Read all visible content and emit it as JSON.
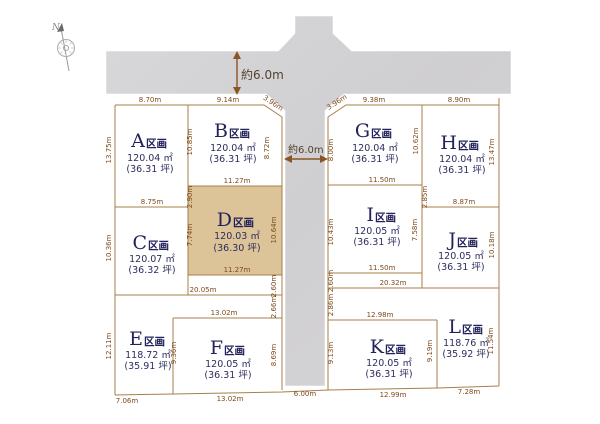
{
  "compass": {
    "north_label": "N"
  },
  "road_labels": {
    "top_width": "約6.0m",
    "center_width": "約6.0m",
    "bottom_width": "6.00m"
  },
  "plots": [
    {
      "id": "A",
      "letter": "A",
      "suffix": "区画",
      "area": "120.04 ㎡",
      "tsubo": "(36.31 坪)"
    },
    {
      "id": "B",
      "letter": "B",
      "suffix": "区画",
      "area": "120.04 ㎡",
      "tsubo": "(36.31 坪)"
    },
    {
      "id": "C",
      "letter": "C",
      "suffix": "区画",
      "area": "120.07 ㎡",
      "tsubo": "(36.32 坪)"
    },
    {
      "id": "D",
      "letter": "D",
      "suffix": "区画",
      "area": "120.03 ㎡",
      "tsubo": "(36.30 坪)"
    },
    {
      "id": "E",
      "letter": "E",
      "suffix": "区画",
      "area": "118.72 ㎡",
      "tsubo": "(35.91 坪)"
    },
    {
      "id": "F",
      "letter": "F",
      "suffix": "区画",
      "area": "120.05 ㎡",
      "tsubo": "(36.31 坪)"
    },
    {
      "id": "G",
      "letter": "G",
      "suffix": "区画",
      "area": "120.04 ㎡",
      "tsubo": "(36.31 坪)"
    },
    {
      "id": "H",
      "letter": "H",
      "suffix": "区画",
      "area": "120.04 ㎡",
      "tsubo": "(36.31 坪)"
    },
    {
      "id": "I",
      "letter": "I",
      "suffix": "区画",
      "area": "120.05 ㎡",
      "tsubo": "(36.31 坪)"
    },
    {
      "id": "J",
      "letter": "J",
      "suffix": "区画",
      "area": "120.05 ㎡",
      "tsubo": "(36.31 坪)"
    },
    {
      "id": "K",
      "letter": "K",
      "suffix": "区画",
      "area": "120.05 ㎡",
      "tsubo": "(36.31 坪)"
    },
    {
      "id": "L",
      "letter": "L",
      "suffix": "区画",
      "area": "118.76 ㎡",
      "tsubo": "(35.92 坪)"
    }
  ],
  "dims": {
    "a_top": "8.70m",
    "b_top": "9.14m",
    "g_top": "9.38m",
    "h_top": "8.90m",
    "bd_shared": "11.27m",
    "gi_shared": "11.50m",
    "ac_shared": "8.75m",
    "hj_shared": "8.87m",
    "d_bottom": "11.27m",
    "i_bottom": "11.50m",
    "ef_top": "20.05m",
    "kl_top": "20.32m",
    "f_top": "13.02m",
    "k_top": "12.98m",
    "e_bottom": "7.06m",
    "f_bottom": "13.02m",
    "road_bottom": "6.00m",
    "k_bottom": "12.99m",
    "l_bottom": "7.28m",
    "a_left": "13.75m",
    "ab_shared": "10.85m",
    "b_right": "8.72m",
    "g_left": "8.00m",
    "gh_shared": "10.62m",
    "h_right": "13.47m",
    "d_left_upper": "2.90m",
    "i_left_upper": "2.85m",
    "c_left": "10.36m",
    "d_left": "7.74m",
    "d_right": "10.64m",
    "i_left": "10.43m",
    "i_right": "7.58m",
    "j_right": "10.18m",
    "d_seg": "2.60m",
    "e_seg": "2.66m",
    "i_seg": "2.60m",
    "l_seg": "2.86m",
    "e_left": "12.11m",
    "f_left": "9.36m",
    "f_right": "8.69m",
    "k_left": "9.13m",
    "k_right": "9.19m",
    "l_right": "11.54m",
    "b_diag": "3.96m",
    "g_diag": "3.96m"
  },
  "colors": {
    "boundary_tan": "#a67f4a",
    "plot_highlight": "#dcc398",
    "road_gray": "#d2d1d4",
    "dimension_text": "#7d4a1c",
    "plot_name_text": "#23235c"
  }
}
